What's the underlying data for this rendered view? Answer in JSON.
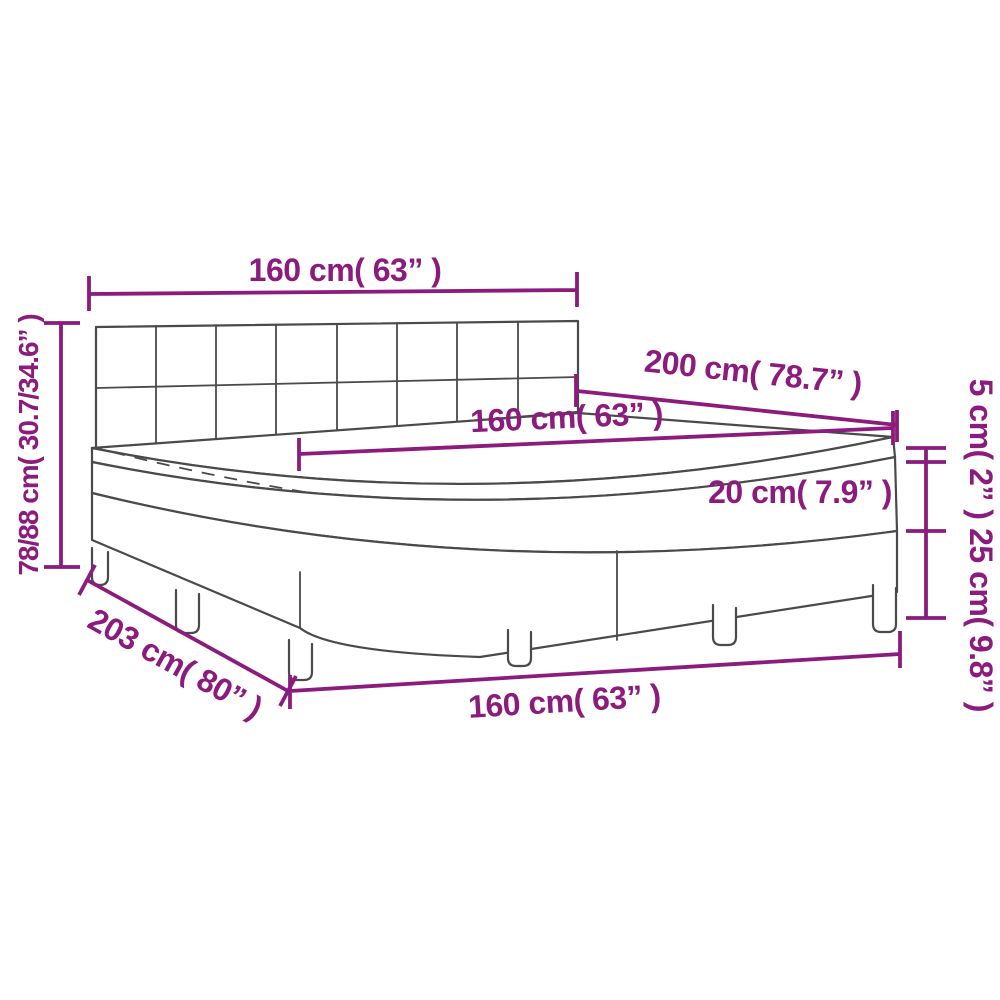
{
  "diagram": {
    "type": "furniture-dimension-diagram",
    "subject": "box spring bed with tufted headboard, mattress topper, mattress and slatted base on legs",
    "colors": {
      "dimension_annotation": "#8b1b7d",
      "drawing_line": "#4a4a4a",
      "background": "#ffffff"
    },
    "dims": {
      "headboard_width": "160 cm( 63” )",
      "total_height": "78/88 cm( 30.7/34.6” )",
      "bed_length": "200 cm( 78.7” )",
      "mattress_width": "160 cm( 63” )",
      "topper_thickness": "5 cm( 2” )",
      "mattress_thickness": "20 cm( 7.9” )",
      "base_thickness": "25 cm( 9.8” )",
      "base_length": "203 cm( 80” )",
      "base_width": "160 cm( 63” )"
    }
  }
}
